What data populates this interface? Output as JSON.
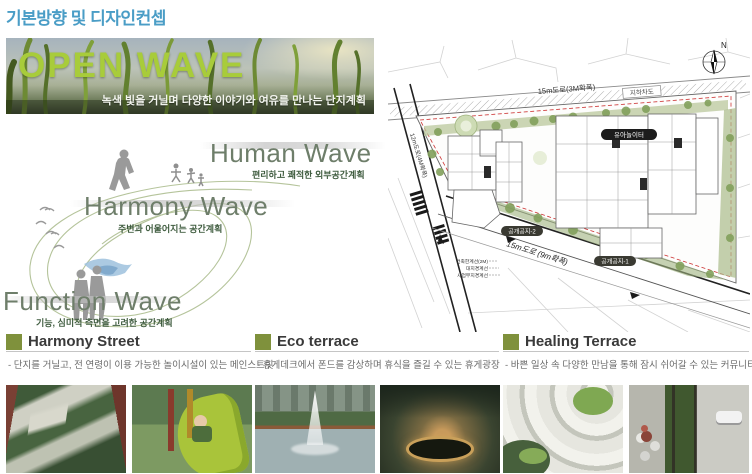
{
  "page_title": "기본방향 및 디자인컨셉",
  "banner": {
    "title": "OPEN WAVE",
    "subtitle": "녹색 빛을 거닐며 다양한 이야기와 여유를 만나는 단지계획"
  },
  "waves": [
    {
      "name": "Human Wave",
      "desc": "편리하고 쾌적한 외부공간계획"
    },
    {
      "name": "Harmony Wave",
      "desc": "주변과 어울어지는 공간계획"
    },
    {
      "name": "Function Wave",
      "desc": "기능, 심미적 측면을 고려한 공간계획"
    }
  ],
  "siteplan": {
    "north": "N",
    "road_top": "15m도로(3M확폭)",
    "road_left": "12m도로(4M확폭)",
    "road_bottom": "15m도로 (9m확폭)",
    "underpass": "지하차도",
    "pill_playground": "유아놀이터",
    "pill_open2": "공개공지-2",
    "pill_open1": "공개공지-1",
    "note_building_limit": "건축한계선(2M)",
    "note_site_boundary": "대지경계선",
    "note_project_boundary": "사업부지경계선"
  },
  "sections": [
    {
      "title": "Harmony Street",
      "desc": "- 단지를 거닐고, 전 연령이 이용 가능한 놀이시설이 있는 메인스트릿"
    },
    {
      "title": "Eco terrace",
      "desc": "- 휴게데크에서 폰드를 감상하며 휴식을 즐길 수 있는 휴게광장"
    },
    {
      "title": "Healing Terrace",
      "desc": "- 바쁜 일상 속 다양한 만남을 통해 잠시 쉬어갈 수 있는 커뮤니티광장"
    }
  ],
  "colors": {
    "title_blue": "#4a9dc6",
    "banner_green": "#a8cc3a",
    "olive_square": "#7f913c",
    "wave_text": "#6e7e6a",
    "wave_desc_green": "#3f5c3f",
    "boundary_red": "#cc3333"
  }
}
